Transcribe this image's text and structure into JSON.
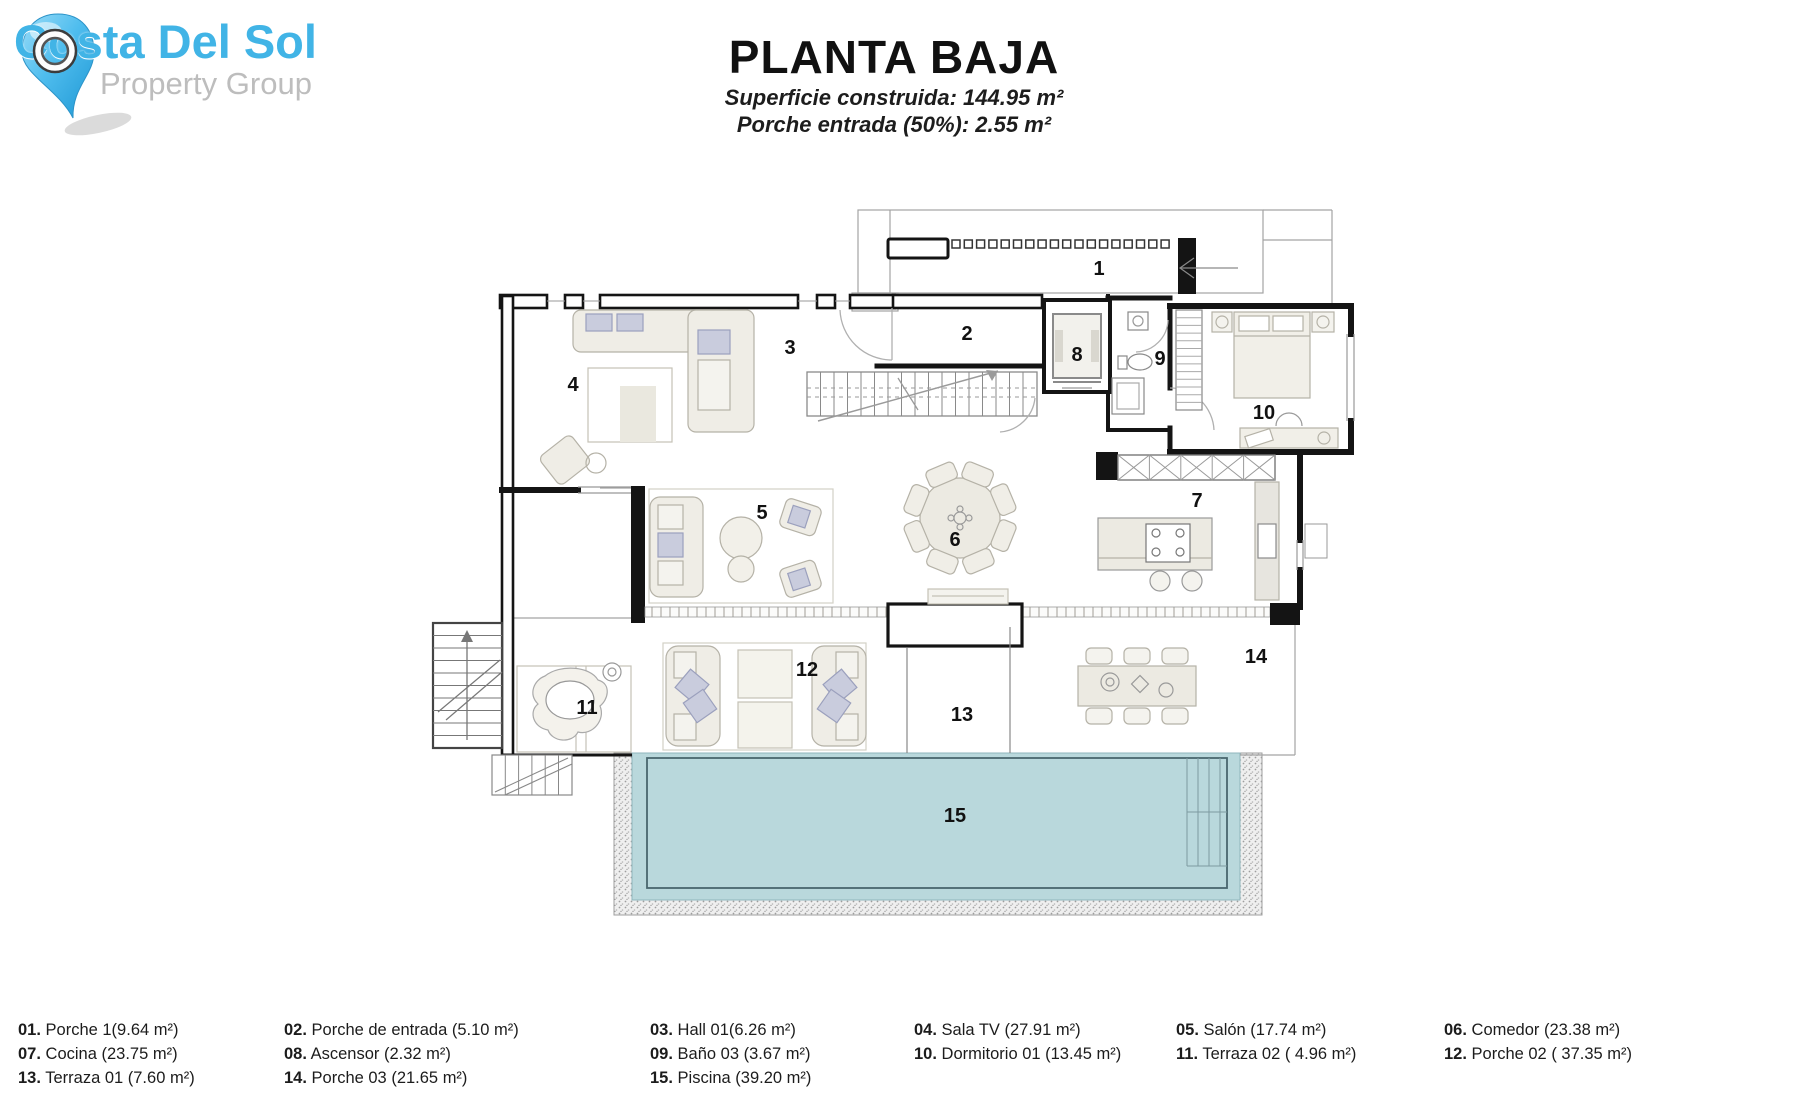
{
  "logo": {
    "brand": "Costa Del Sol",
    "tagline": "Property Group",
    "brand_color": "#41b4e6",
    "tagline_color": "#bdbdbd",
    "pin_color": "#3fb2e8"
  },
  "header": {
    "title": "PLANTA BAJA",
    "subtitle1": "Superficie construida: 144.95 m²",
    "subtitle2": "Porche entrada (50%): 2.55 m²"
  },
  "plan": {
    "pool_color": "#b9d8dc",
    "pool_edge_color": "#49666e",
    "wall_color": "#141414",
    "room_labels": [
      {
        "id": "1",
        "x": 1099,
        "y": 275
      },
      {
        "id": "2",
        "x": 967,
        "y": 340
      },
      {
        "id": "3",
        "x": 790,
        "y": 354
      },
      {
        "id": "4",
        "x": 573,
        "y": 391
      },
      {
        "id": "5",
        "x": 762,
        "y": 519
      },
      {
        "id": "6",
        "x": 955,
        "y": 546
      },
      {
        "id": "7",
        "x": 1197,
        "y": 507
      },
      {
        "id": "8",
        "x": 1077,
        "y": 361
      },
      {
        "id": "9",
        "x": 1160,
        "y": 365
      },
      {
        "id": "10",
        "x": 1264,
        "y": 419
      },
      {
        "id": "11",
        "x": 587,
        "y": 714
      },
      {
        "id": "12",
        "x": 807,
        "y": 676
      },
      {
        "id": "13",
        "x": 962,
        "y": 721
      },
      {
        "id": "14",
        "x": 1256,
        "y": 663
      },
      {
        "id": "15",
        "x": 955,
        "y": 822
      }
    ]
  },
  "legend": {
    "columns": [
      [
        {
          "num": "01.",
          "label": "Porche 1(9.64 m²)"
        },
        {
          "num": "07.",
          "label": "Cocina (23.75 m²)"
        },
        {
          "num": "13.",
          "label": "Terraza 01 (7.60 m²)"
        }
      ],
      [
        {
          "num": "02.",
          "label": "Porche de entrada (5.10 m²)"
        },
        {
          "num": "08.",
          "label": "Ascensor (2.32 m²)"
        },
        {
          "num": "14.",
          "label": "Porche 03 (21.65 m²)"
        }
      ],
      [
        {
          "num": "03.",
          "label": "Hall 01(6.26 m²)"
        },
        {
          "num": "09.",
          "label": "Baño 03 (3.67 m²)"
        },
        {
          "num": "15.",
          "label": "Piscina (39.20 m²)"
        }
      ],
      [
        {
          "num": "04.",
          "label": "Sala TV (27.91 m²)"
        },
        {
          "num": "10.",
          "label": "Dormitorio 01 (13.45 m²)"
        }
      ],
      [
        {
          "num": "05.",
          "label": "Salón (17.74 m²)"
        },
        {
          "num": "11.",
          "label": "Terraza 02 ( 4.96 m²)"
        }
      ],
      [
        {
          "num": "06.",
          "label": "Comedor (23.38 m²)"
        },
        {
          "num": "12.",
          "label": "Porche 02 ( 37.35 m²)"
        }
      ]
    ]
  }
}
